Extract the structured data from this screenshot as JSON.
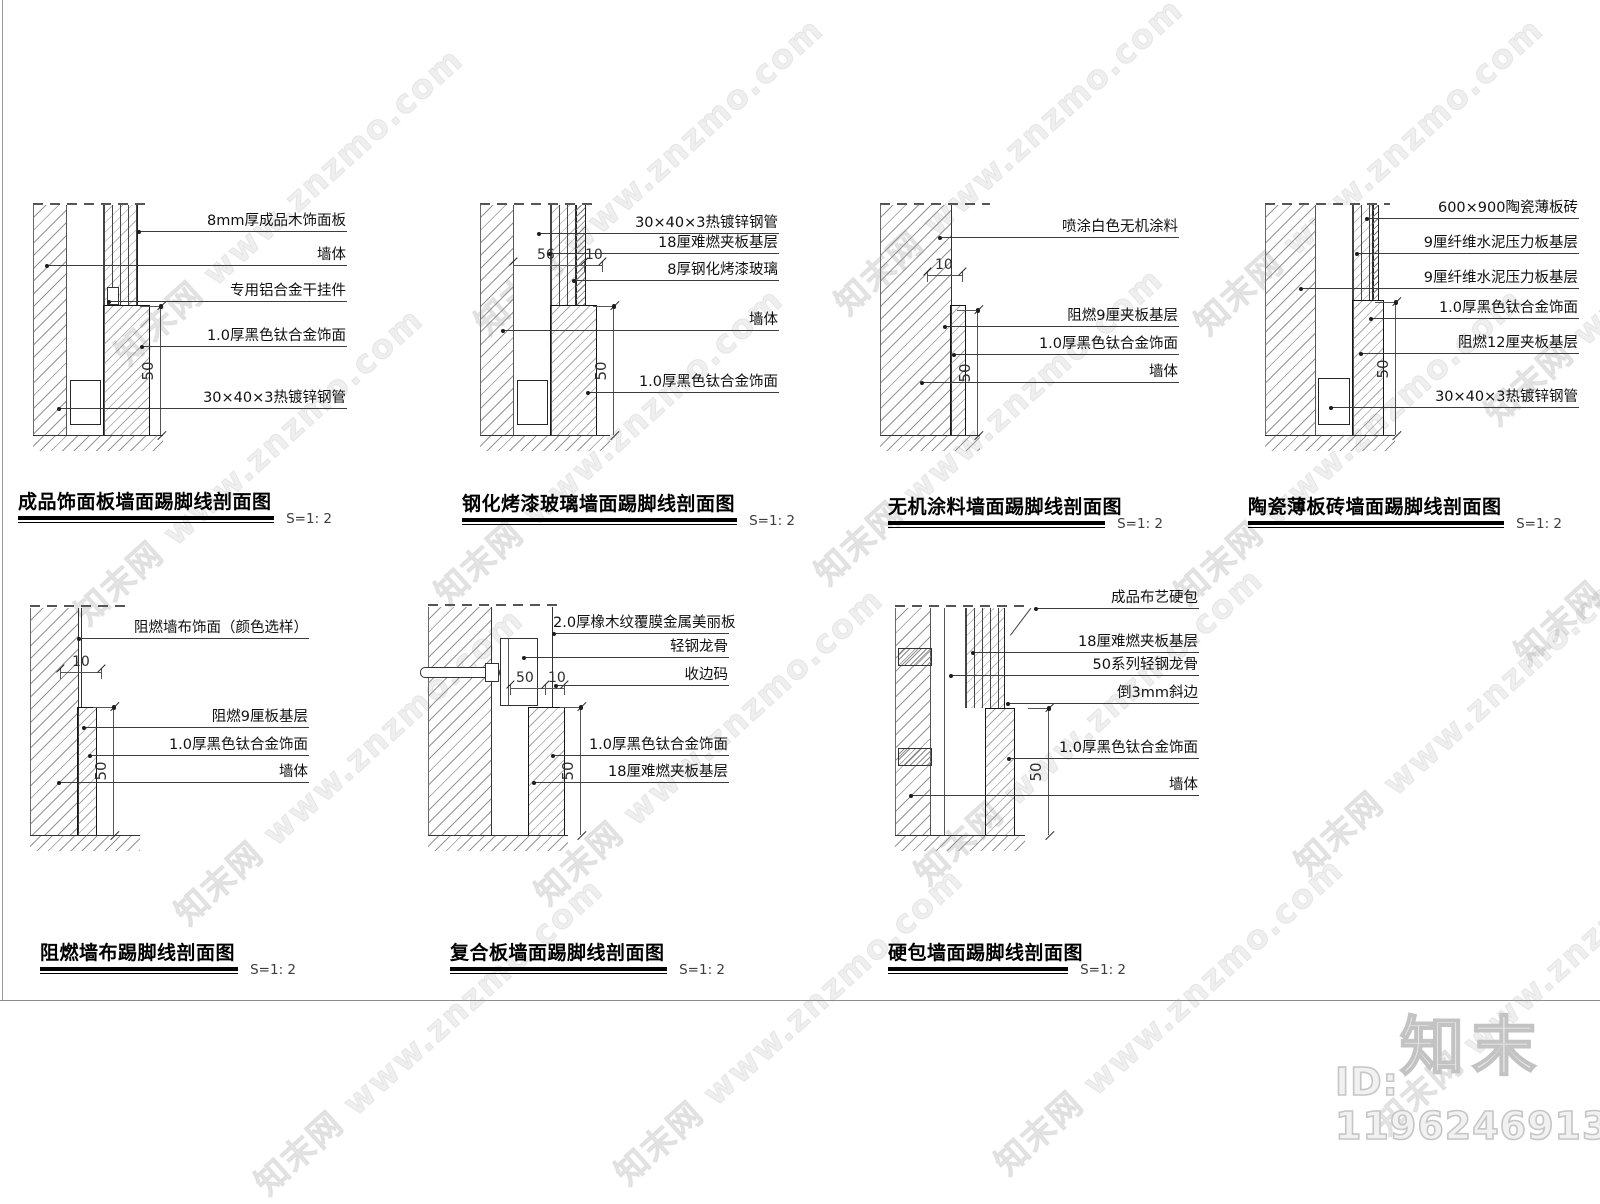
{
  "page": {
    "watermark": {
      "text": "知末网 www.znzmo.com"
    },
    "brand": {
      "logo_text": "知末",
      "id_label": "ID: 1196246913"
    }
  },
  "details": [
    {
      "title": "成品饰面板墙面踢脚线剖面图",
      "scale": "S=1: 2",
      "labels": [
        "8mm厚成品木饰面板",
        "墙体",
        "专用铝合金干挂件",
        "1.0厚黑色钛合金饰面",
        "30×40×3热镀锌钢管"
      ],
      "dims": {
        "v": "50"
      }
    },
    {
      "title": "钢化烤漆玻璃墙面踢脚线剖面图",
      "scale": "S=1: 2",
      "labels": [
        "30×40×3热镀锌钢管",
        "18厘难燃夹板基层",
        "8厚钢化烤漆玻璃",
        "墙体",
        "1.0厚黑色钛合金饰面"
      ],
      "dims": {
        "h1": "56",
        "h2": "10",
        "v": "50"
      }
    },
    {
      "title": "无机涂料墙面踢脚线剖面图",
      "scale": "S=1: 2",
      "labels": [
        "喷涂白色无机涂料",
        "阻燃9厘夹板基层",
        "1.0厚黑色钛合金饰面",
        "墙体"
      ],
      "dims": {
        "h1": "10",
        "v": "50"
      }
    },
    {
      "title": "陶瓷薄板砖墙面踢脚线剖面图",
      "scale": "S=1: 2",
      "labels": [
        "600×900陶瓷薄板砖",
        "9厘纤维水泥压力板基层",
        "9厘纤维水泥压力板基层",
        "1.0厚黑色钛合金饰面",
        "阻燃12厘夹板基层",
        "30×40×3热镀锌钢管"
      ],
      "dims": {
        "v": "50"
      }
    },
    {
      "title": "阻燃墙布踢脚线剖面图",
      "scale": "S=1: 2",
      "labels": [
        "阻燃墙布饰面（颜色选样）",
        "阻燃9厘板基层",
        "1.0厚黑色钛合金饰面",
        "墙体"
      ],
      "dims": {
        "h1": "10",
        "v": "50"
      }
    },
    {
      "title": "复合板墙面踢脚线剖面图",
      "scale": "S=1: 2",
      "labels": [
        "2.0厚橡木纹覆膜金属美丽板",
        "轻钢龙骨",
        "收边码",
        "1.0厚黑色钛合金饰面",
        "18厘难燃夹板基层"
      ],
      "dims": {
        "h1": "50",
        "h2": "10",
        "v": "50"
      }
    },
    {
      "title": "硬包墙面踢脚线剖面图",
      "scale": "S=1: 2",
      "labels": [
        "成品布艺硬包",
        "18厘难燃夹板基层",
        "50系列轻钢龙骨",
        "倒3mm斜边",
        "1.0厚黑色钛合金饰面",
        "墙体"
      ],
      "dims": {
        "v": "50"
      }
    }
  ]
}
